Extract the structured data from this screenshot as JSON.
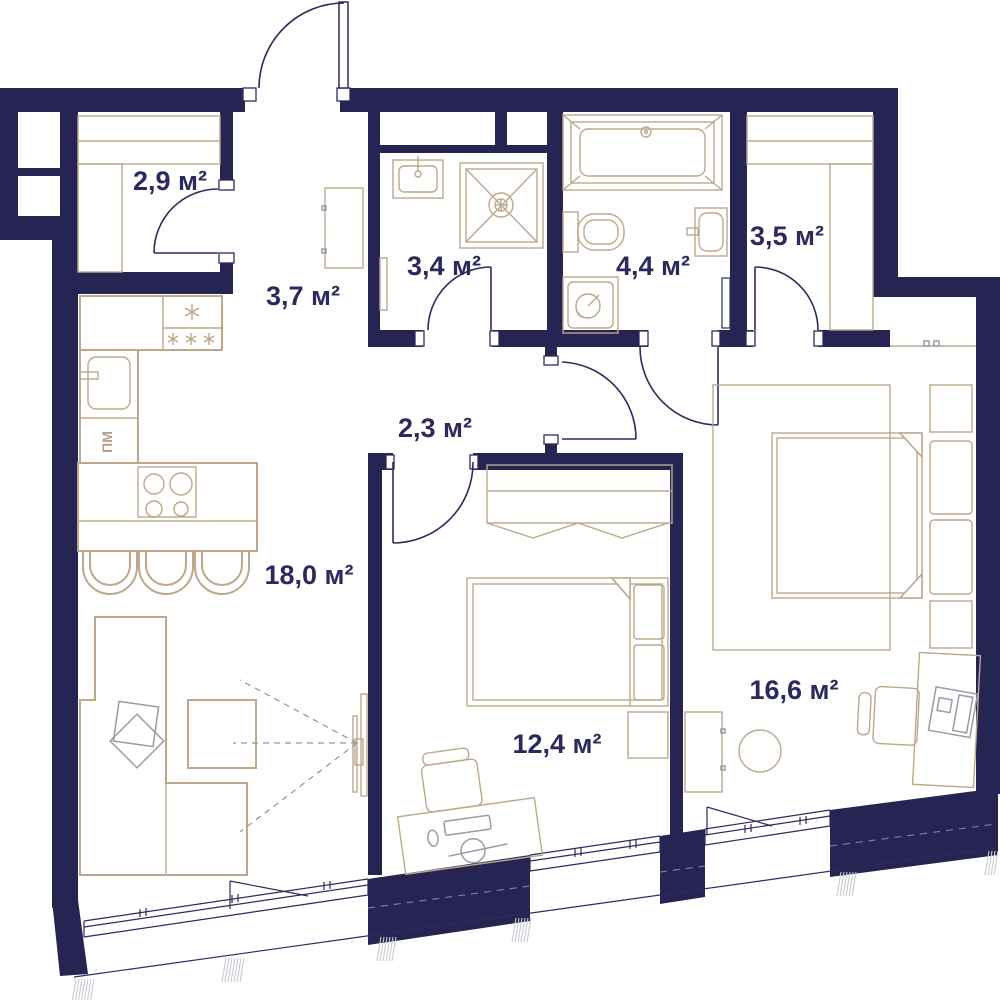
{
  "title": "Apartment floor plan",
  "rooms": [
    {
      "name": "dressing-room-1",
      "area": "2,9 м²"
    },
    {
      "name": "hallway",
      "area": "3,7 м²"
    },
    {
      "name": "bathroom-shower",
      "area": "3,4 м²"
    },
    {
      "name": "bathroom-main",
      "area": "4,4 м²"
    },
    {
      "name": "dressing-room-2",
      "area": "3,5 м²"
    },
    {
      "name": "corridor",
      "area": "2,3 м²"
    },
    {
      "name": "kitchen-living-room",
      "area": "18,0 м²"
    },
    {
      "name": "bedroom",
      "area": "12,4 м²"
    },
    {
      "name": "master-bedroom",
      "area": "16,6 м²"
    }
  ],
  "annotations": {
    "dishwasher": "ПМ",
    "fridge_single_star": "*",
    "fridge_triple_star": "***"
  },
  "colors": {
    "wall": "#262453",
    "furniture_outline": "#bda88b",
    "door_line": "#2d2b5e",
    "gray_detail": "#9b9ba8",
    "label_text": "#2b2a5c",
    "background": "#ffffff"
  }
}
